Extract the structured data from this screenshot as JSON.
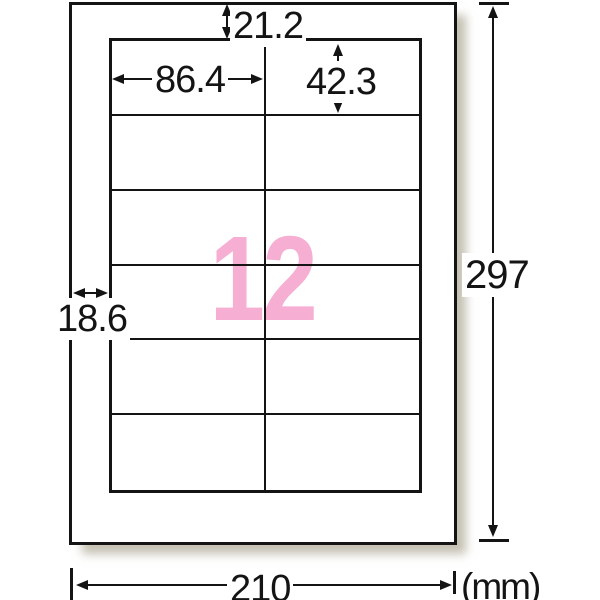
{
  "diagram": {
    "kind": "label-sheet-dimension-diagram",
    "labels_per_sheet": "12",
    "unit_label": "(mm)",
    "page": {
      "width_mm": "210",
      "height_mm": "297"
    },
    "label_cell": {
      "width_mm": "86.4",
      "height_mm": "42.3"
    },
    "margins": {
      "top_mm": "21.2",
      "left_mm": "18.6"
    },
    "grid": {
      "columns": 2,
      "rows": 6
    },
    "colors": {
      "accent_pink": "#f6aed2",
      "line_ink": "#141414"
    }
  }
}
